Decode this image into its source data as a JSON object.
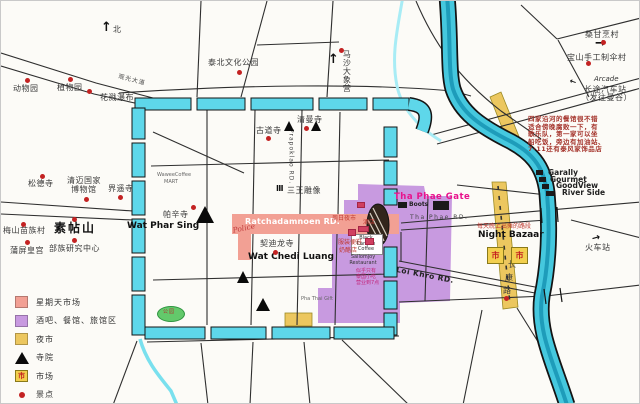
{
  "colors": {
    "moat": "#5ed7ea",
    "river": "#45c8de",
    "sunday_market": "#f2a094",
    "bar_zone": "#c89ae0",
    "night_market": "#ecc75f",
    "park_green": "#63c96b",
    "accent_red": "#c32222",
    "magenta": "#e8128c"
  },
  "legend": {
    "market_symbol": "市",
    "items": [
      {
        "symbol": "pink-square",
        "label": "星期天市场"
      },
      {
        "symbol": "purple-square",
        "label": "酒吧、餐馆、旅馆区"
      },
      {
        "symbol": "yellow-square",
        "label": "夜市"
      },
      {
        "symbol": "black-triangle",
        "label": "寺院"
      },
      {
        "symbol": "market-square",
        "label": "市场"
      },
      {
        "symbol": "red-dot",
        "label": "景点"
      }
    ]
  },
  "map": {
    "market_symbol": "市",
    "labels": [
      {
        "name": "zoo-label",
        "text": "动物园",
        "x": 12,
        "y": 84,
        "cls": "zh"
      },
      {
        "name": "botanical-garden-label",
        "text": "植物园",
        "x": 56,
        "y": 83,
        "cls": "zh"
      },
      {
        "name": "waterfall-label",
        "text": "花溅瀑布",
        "x": 99,
        "y": 93,
        "cls": "zh"
      },
      {
        "name": "sightseeing-avenue-label",
        "text": "观光大道",
        "x": 118,
        "y": 73,
        "cls": "road",
        "rot": 15
      },
      {
        "name": "north-arrow-icon",
        "text": "↑",
        "x": 100,
        "y": 20,
        "cls": "ic2"
      },
      {
        "name": "north-label",
        "text": "北",
        "x": 112,
        "y": 25,
        "cls": "zh"
      },
      {
        "name": "cultural-park-label",
        "text": "泰北文化公园",
        "x": 207,
        "y": 58,
        "cls": "zh"
      },
      {
        "name": "elephant-camp-label",
        "text": "马沙大象营",
        "x": 341,
        "y": 49,
        "cls": "zh vert"
      },
      {
        "name": "elephant-camp-arrow-icon",
        "text": "↑",
        "x": 327,
        "y": 52,
        "cls": "ic2"
      },
      {
        "name": "sankamphaeng-label",
        "text": "桑甘烹村",
        "x": 584,
        "y": 30,
        "cls": "zh"
      },
      {
        "name": "sankamphaeng-arrow-icon",
        "text": "→",
        "x": 594,
        "y": 36,
        "cls": "ic2"
      },
      {
        "name": "bosang-label",
        "text": "宝山手工制伞村",
        "x": 566,
        "y": 53,
        "cls": "zh"
      },
      {
        "name": "arcade-label",
        "text": "Arcade",
        "x": 593,
        "y": 75,
        "cls": "en-i"
      },
      {
        "name": "bus-station-arrow-icon",
        "text": "→",
        "x": 574,
        "y": 85,
        "cls": "ic",
        "rot": 200
      },
      {
        "name": "bus-station-label",
        "text": "长途汽车站",
        "x": 583,
        "y": 85,
        "cls": "zh"
      },
      {
        "name": "bus-station-note",
        "text": "（发往曼谷）",
        "x": 580,
        "y": 93,
        "cls": "zh"
      },
      {
        "name": "river-note-1",
        "text": "四家沿河的餐馆很不错",
        "x": 527,
        "y": 115,
        "cls": "note"
      },
      {
        "name": "river-note-2",
        "text": "适合傍晚腐败一下，有",
        "x": 527,
        "y": 122.5,
        "cls": "note"
      },
      {
        "name": "river-note-3",
        "text": "歌乐队，第一家可以坐",
        "x": 527,
        "y": 130,
        "cls": "note"
      },
      {
        "name": "river-note-4",
        "text": "船吃饭，旁边有加油站、",
        "x": 527,
        "y": 137.5,
        "cls": "note"
      },
      {
        "name": "river-note-5",
        "text": "7-11还有泰风家饰品店",
        "x": 527,
        "y": 145,
        "cls": "note"
      },
      {
        "name": "restaurant-garally-label",
        "text": "Garally",
        "x": 547,
        "y": 168,
        "cls": "rname"
      },
      {
        "name": "restaurant-gourmet-label",
        "text": "Gourmet",
        "x": 549,
        "y": 175,
        "cls": "rname"
      },
      {
        "name": "restaurant-goodview-label",
        "text": "GoodView",
        "x": 555,
        "y": 181,
        "cls": "rname"
      },
      {
        "name": "restaurant-riverside-label",
        "text": "River Side",
        "x": 561,
        "y": 188,
        "cls": "rname"
      },
      {
        "name": "wat-suan-dok-label",
        "text": "松德寺",
        "x": 27,
        "y": 179,
        "cls": "zh"
      },
      {
        "name": "national-museum-label-1",
        "text": "清迈国家",
        "x": 66,
        "y": 176,
        "cls": "zh"
      },
      {
        "name": "national-museum-label-2",
        "text": "博物馆",
        "x": 70,
        "y": 185,
        "cls": "zh"
      },
      {
        "name": "wat-jed-yod-label",
        "text": "界遥寺",
        "x": 107,
        "y": 184,
        "cls": "zh"
      },
      {
        "name": "doi-suthep-label",
        "text": "素帖山",
        "x": 53,
        "y": 221,
        "cls": "zh-b"
      },
      {
        "name": "hmong-village-label",
        "text": "梅山苗族村",
        "x": 2,
        "y": 226,
        "cls": "zh"
      },
      {
        "name": "bhubing-palace-label",
        "text": "蒲屏皇宫",
        "x": 9,
        "y": 246,
        "cls": "zh"
      },
      {
        "name": "tribal-center-label",
        "text": "部族研究中心",
        "x": 48,
        "y": 244,
        "cls": "zh"
      },
      {
        "name": "wat-ku-tao-label",
        "text": "古道寺",
        "x": 255,
        "y": 126,
        "cls": "zh"
      },
      {
        "name": "wat-chiang-man-label",
        "text": "清曼寺",
        "x": 296,
        "y": 115,
        "cls": "zh"
      },
      {
        "name": "wawee-coffee-label",
        "text": "WaweeCoffee",
        "x": 156,
        "y": 172,
        "cls": "tiny"
      },
      {
        "name": "wawee-mart-label",
        "text": "MART",
        "x": 163,
        "y": 179,
        "cls": "tiny"
      },
      {
        "name": "three-kings-monument-icon",
        "text": "Ⅲ",
        "x": 275,
        "y": 184,
        "cls": "ic"
      },
      {
        "name": "three-kings-label",
        "text": "三王雕像",
        "x": 286,
        "y": 186,
        "cls": "zh"
      },
      {
        "name": "prapoklao-road-label",
        "text": "Prapoklao RD.",
        "x": 286,
        "y": 128,
        "cls": "road vert"
      },
      {
        "name": "wat-phra-singh-label-zh",
        "text": "帕辛寺",
        "x": 162,
        "y": 210,
        "cls": "zh"
      },
      {
        "name": "wat-phra-singh-label-en",
        "text": "Wat Phar Sing",
        "x": 126,
        "y": 221,
        "cls": "en-b"
      },
      {
        "name": "ratchadamnoen-road-label",
        "text": "Ratchadamnoen RD.",
        "x": 244,
        "y": 217,
        "cls": "rd-white"
      },
      {
        "name": "sunday-night-market-label",
        "text": "周日夜市",
        "x": 331,
        "y": 215,
        "cls": "tiny-red"
      },
      {
        "name": "hotel-label",
        "text": "酒店",
        "x": 362,
        "y": 219,
        "cls": "tiny-red"
      },
      {
        "name": "police-label",
        "text": "Police",
        "x": 231,
        "y": 226,
        "cls": "police",
        "rot": -12
      },
      {
        "name": "wat-chedi-luang-label-zh",
        "text": "契迪龙寺",
        "x": 259,
        "y": 239,
        "cls": "zh"
      },
      {
        "name": "wat-chedi-luang-label-en",
        "text": "Wat Chedi Luang",
        "x": 247,
        "y": 252,
        "cls": "en-b"
      },
      {
        "name": "clothing-shoes-label",
        "text": "服装便鞋",
        "x": 337,
        "y": 239,
        "cls": "tiny-red"
      },
      {
        "name": "cheese-shop-label",
        "text": "奶酪店",
        "x": 338,
        "y": 247,
        "cls": "tiny-red"
      },
      {
        "name": "black-canyon-coffee-label",
        "text": "Black Canyon Coffee",
        "x": 352,
        "y": 235,
        "cls": "tiny-c",
        "w": 26
      },
      {
        "name": "sailomjoy-restaurant-label",
        "text": "Sailomjoy Restaurant",
        "x": 347,
        "y": 254,
        "cls": "tiny-c",
        "w": 30
      },
      {
        "name": "thai-snack-note-1",
        "text": "似乎只有",
        "x": 355,
        "y": 268,
        "cls": "tiny-mag"
      },
      {
        "name": "thai-snack-note-2",
        "text": "泰国小吃",
        "x": 355,
        "y": 274,
        "cls": "tiny-mag"
      },
      {
        "name": "thai-snack-note-3",
        "text": "营业到7点",
        "x": 355,
        "y": 280,
        "cls": "tiny-mag"
      },
      {
        "name": "tha-phae-gate-label",
        "text": "Tha Phae Gate",
        "x": 393,
        "y": 192,
        "cls": "magenta"
      },
      {
        "name": "boots-label",
        "text": "Boots",
        "x": 408,
        "y": 201,
        "cls": "tiny-b"
      },
      {
        "name": "seven-eleven-label",
        "text": "7-11",
        "x": 434,
        "y": 202,
        "cls": "sev"
      },
      {
        "name": "tha-phae-road-label",
        "text": "Tha Phae RD.",
        "x": 409,
        "y": 214,
        "cls": "road-sp"
      },
      {
        "name": "loi-khro-road-label",
        "text": "Loi Khro RD.",
        "x": 396,
        "y": 265,
        "cls": "en-b2",
        "rot": 11
      },
      {
        "name": "night-bazaar-note-label",
        "text": "每天晚上出摊的路段",
        "x": 476,
        "y": 223,
        "cls": "tiny-red"
      },
      {
        "name": "night-bazaar-label",
        "text": "Night Bazaar",
        "x": 477,
        "y": 230,
        "cls": "en-b"
      },
      {
        "name": "chang-klan-char-1",
        "text": "长",
        "x": 507,
        "y": 260,
        "cls": "zh"
      },
      {
        "name": "chang-klan-char-2",
        "text": "康",
        "x": 504,
        "y": 273,
        "cls": "zh"
      },
      {
        "name": "chang-klan-char-3",
        "text": "路",
        "x": 502,
        "y": 286,
        "cls": "zh"
      },
      {
        "name": "train-station-arrow-icon",
        "text": "→",
        "x": 590,
        "y": 234,
        "cls": "ic3",
        "rot": -15
      },
      {
        "name": "train-station-label",
        "text": "火车站",
        "x": 584,
        "y": 243,
        "cls": "zh"
      },
      {
        "name": "pha-thai-gift-label",
        "text": "Pha Thai Gift",
        "x": 300,
        "y": 296,
        "cls": "tiny"
      },
      {
        "name": "park-label",
        "text": "公园",
        "x": 162,
        "y": 309,
        "cls": "park-t"
      }
    ],
    "poi_dots": [
      [
        24,
        77
      ],
      [
        67,
        76
      ],
      [
        86,
        88
      ],
      [
        236,
        69
      ],
      [
        338,
        47
      ],
      [
        600,
        39
      ],
      [
        585,
        60
      ],
      [
        39,
        173
      ],
      [
        83,
        196
      ],
      [
        117,
        194
      ],
      [
        71,
        216
      ],
      [
        20,
        221
      ],
      [
        24,
        239
      ],
      [
        71,
        237
      ],
      [
        265,
        135
      ],
      [
        303,
        125
      ],
      [
        190,
        204
      ],
      [
        272,
        249
      ],
      [
        503,
        295
      ]
    ],
    "temple_triangles": [
      [
        288,
        120,
        11
      ],
      [
        315,
        120,
        11
      ],
      [
        204,
        205,
        18
      ],
      [
        242,
        270,
        13
      ],
      [
        262,
        297,
        14
      ]
    ],
    "black_squares": [
      [
        535,
        169,
        7,
        5
      ],
      [
        538,
        176,
        7,
        5
      ],
      [
        541,
        183,
        7,
        5
      ],
      [
        545,
        190,
        8,
        5
      ],
      [
        397,
        201,
        9,
        6
      ],
      [
        432,
        200,
        16,
        9
      ]
    ],
    "pink_squares": [
      [
        356,
        201,
        8,
        6
      ],
      [
        347,
        228,
        8,
        7
      ],
      [
        364,
        237,
        9,
        7
      ],
      [
        357,
        225,
        11,
        6
      ]
    ],
    "market_squares": [
      [
        486,
        246
      ],
      [
        510,
        246
      ]
    ]
  }
}
